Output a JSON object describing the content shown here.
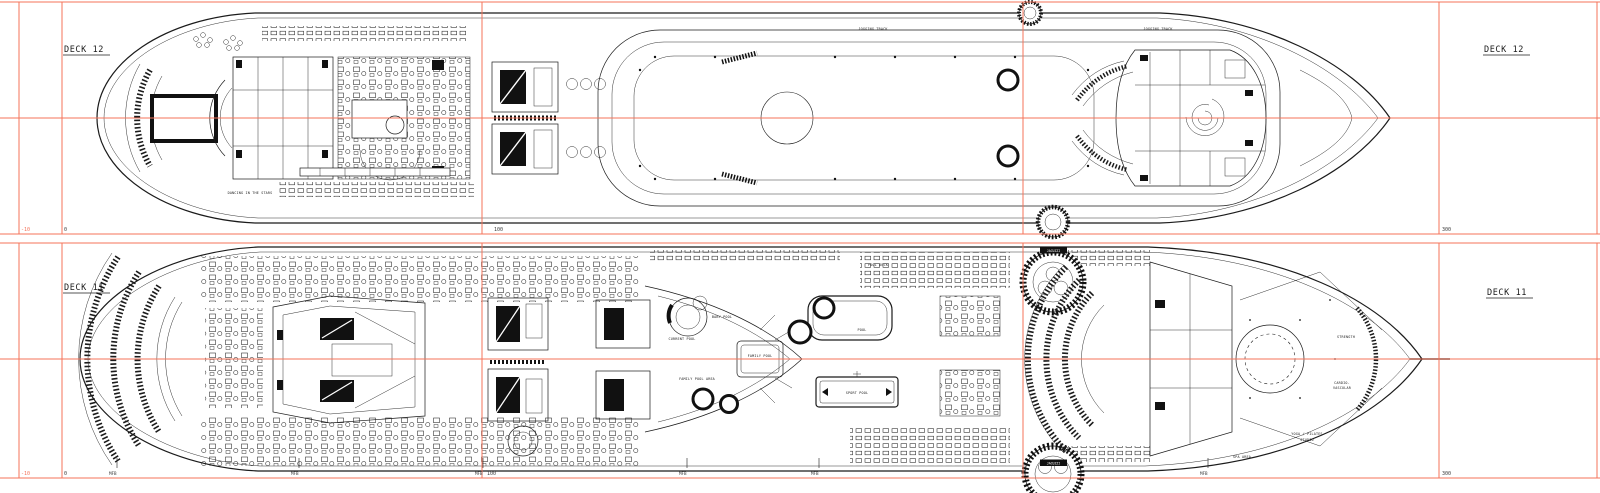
{
  "deck12": {
    "title": "DECK 12",
    "grid_labels": {
      "minus10": "-10",
      "zero": "0",
      "one_hundred": "100",
      "three_hundred": "300"
    },
    "area_labels": {
      "jogging_track": "JOGGING TRACK",
      "dancing_in_the_stars": "DANCING IN THE STARS"
    }
  },
  "deck11": {
    "title": "DECK 11",
    "grid_labels": {
      "minus10": "-10",
      "zero": "0",
      "one_hundred": "100",
      "three_hundred": "300",
      "mfb": "MFB"
    },
    "area_labels": {
      "pool_deck": "POOL DECK",
      "current_pool": "CURRENT POOL",
      "baby_pool": "BABY POOL",
      "family_pool": "FAMILY POOL",
      "family_pool_area": "FAMILY POOL AREA",
      "pool": "POOL",
      "sport_pool": "SPORT POOL",
      "jacuzzi": "JACUZZI",
      "strength": "STRENGTH",
      "cardio_line1": "CARDIO-",
      "cardio_line2": "VASCULAR",
      "yoga_line1": "YOGA / PILATES",
      "yoga_line2": "STUDIO",
      "spa_area": "SPA AREA"
    }
  },
  "colors": {
    "grid_line": "#f4735a",
    "ink": "#1b1b1b",
    "paper": "#ffffff"
  }
}
